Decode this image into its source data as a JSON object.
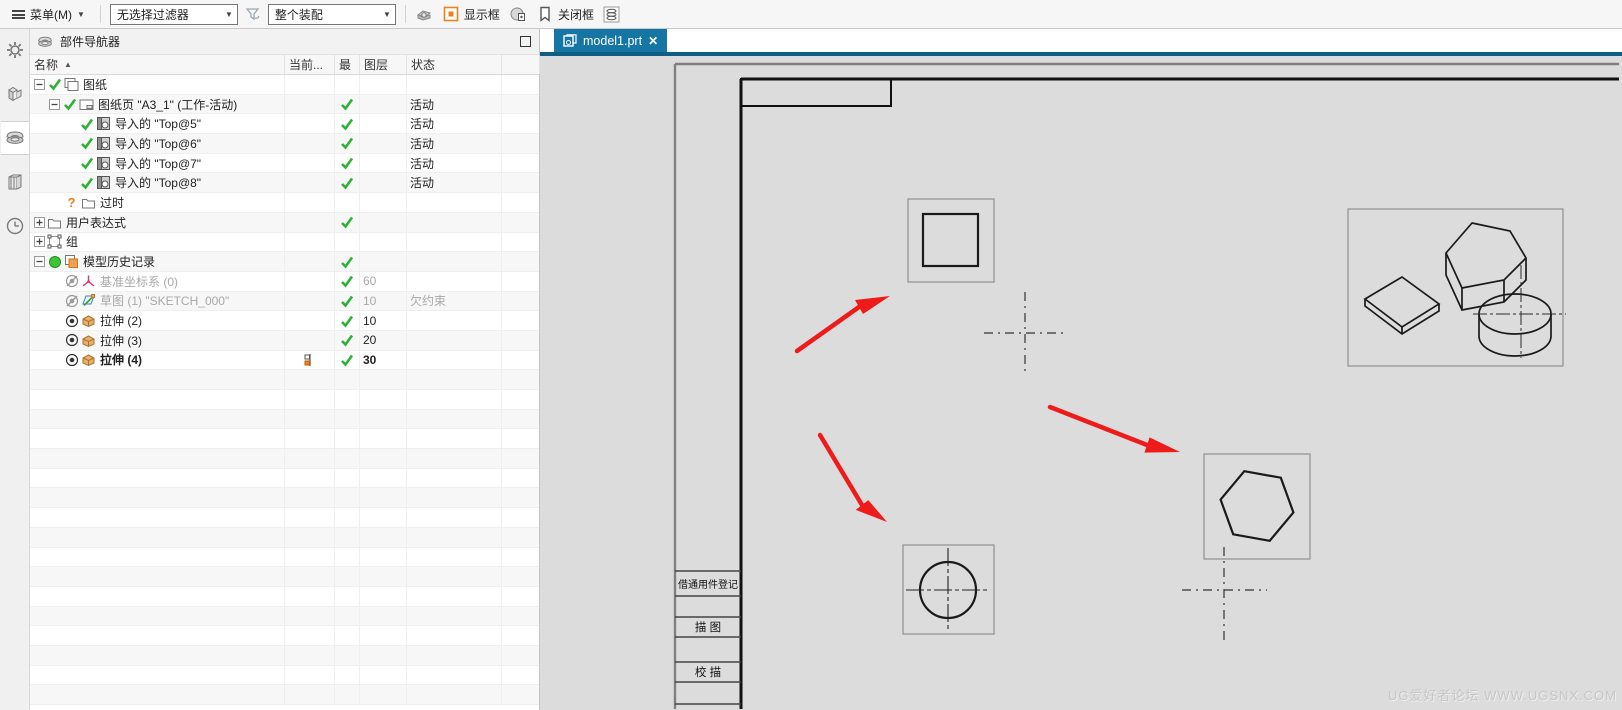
{
  "toolbar": {
    "menu_label": "菜单(M)",
    "selection_filter": "无选择过滤器",
    "scope_filter": "整个装配",
    "show_box_label": "显示框",
    "close_box_label": "关闭框"
  },
  "sidebar": {
    "items": [
      {
        "name": "settings"
      },
      {
        "name": "assembly-navigator"
      },
      {
        "name": "part-navigator",
        "active": true
      },
      {
        "name": "reuse-library"
      },
      {
        "name": "history"
      }
    ]
  },
  "navigator": {
    "title": "部件导航器",
    "columns": {
      "name": "名称",
      "current": "当前...",
      "latest": "最",
      "layer": "图层",
      "status": "状态"
    },
    "rows": [
      {
        "indent": 0,
        "expand": "minus",
        "pre": [
          "check"
        ],
        "icon": "sheets",
        "label": "图纸"
      },
      {
        "indent": 1,
        "expand": "minus",
        "pre": [
          "check"
        ],
        "icon": "sheet",
        "label": "图纸页 \"A3_1\" (工作-活动)",
        "latest": true,
        "status": "活动"
      },
      {
        "indent": 2,
        "expand": "",
        "pre": [
          "check"
        ],
        "icon": "view",
        "label": "导入的 \"Top@5\"",
        "latest": true,
        "status": "活动"
      },
      {
        "indent": 2,
        "expand": "",
        "pre": [
          "check"
        ],
        "icon": "view",
        "label": "导入的 \"Top@6\"",
        "latest": true,
        "status": "活动"
      },
      {
        "indent": 2,
        "expand": "",
        "pre": [
          "check"
        ],
        "icon": "view",
        "label": "导入的 \"Top@7\"",
        "latest": true,
        "status": "活动"
      },
      {
        "indent": 2,
        "expand": "",
        "pre": [
          "check"
        ],
        "icon": "view",
        "label": "导入的 \"Top@8\"",
        "latest": true,
        "status": "活动"
      },
      {
        "indent": 1,
        "expand": "",
        "pre": [
          "question"
        ],
        "icon": "folder",
        "label": "过时"
      },
      {
        "indent": 0,
        "expand": "plus",
        "pre": [],
        "icon": "folder",
        "label": "用户表达式",
        "latest": true
      },
      {
        "indent": 0,
        "expand": "plus",
        "pre": [],
        "icon": "group",
        "label": "组"
      },
      {
        "indent": 0,
        "expand": "minus",
        "pre": [
          "greenDot"
        ],
        "icon": "history",
        "label": "模型历史记录",
        "latest": true
      },
      {
        "indent": 1,
        "expand": "",
        "pre": [
          "eyeOff"
        ],
        "icon": "csys",
        "label": "基准坐标系 (0)",
        "latest": true,
        "layer": "60",
        "dim": true
      },
      {
        "indent": 1,
        "expand": "",
        "pre": [
          "eyeOff"
        ],
        "icon": "sketch",
        "label": "草图 (1) \"SKETCH_000\"",
        "latest": true,
        "layer": "10",
        "status": "欠约束",
        "dim": true
      },
      {
        "indent": 1,
        "expand": "",
        "pre": [
          "eyeOn"
        ],
        "icon": "extrude",
        "label": "拉伸 (2)",
        "latest": true,
        "layer": "10"
      },
      {
        "indent": 1,
        "expand": "",
        "pre": [
          "eyeOn"
        ],
        "icon": "extrude",
        "label": "拉伸 (3)",
        "latest": true,
        "layer": "20"
      },
      {
        "indent": 1,
        "expand": "",
        "pre": [
          "eyeOn"
        ],
        "icon": "extrude",
        "label": "拉伸 (4)",
        "latest": true,
        "layer": "30",
        "bold": true,
        "current": true
      }
    ]
  },
  "tab": {
    "title": "model1.prt"
  },
  "drawing": {
    "title_block": {
      "row1": "借通用件登记",
      "row2": "描  图",
      "row3": "校  描"
    },
    "watermark": "UG爱好者论坛 WWW.UGSNX.COM"
  },
  "colors": {
    "tab_teal": "#1576a4",
    "accent_strip": "#0e5e86",
    "check_green": "#2eb135",
    "warn_orange": "#e8821e",
    "arrow_red": "#ee1b1b",
    "canvas_gray": "#dcdcdc"
  }
}
